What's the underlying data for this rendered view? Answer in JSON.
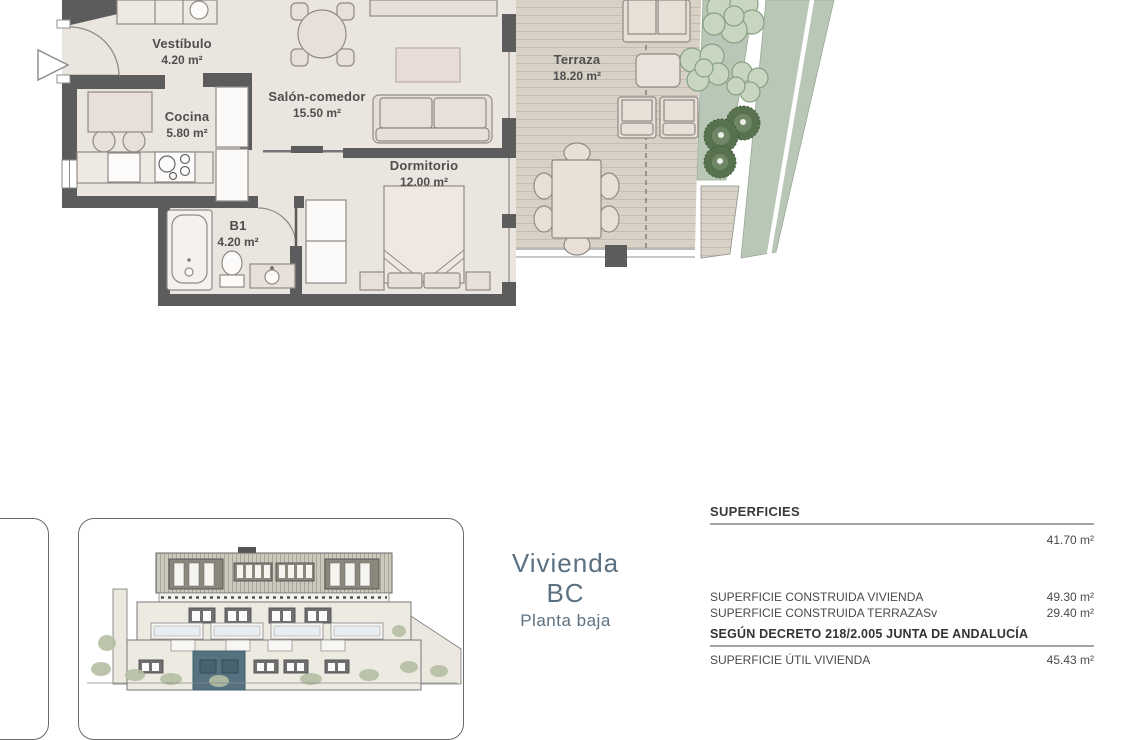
{
  "plan": {
    "rooms": [
      {
        "name": "Vestíbulo",
        "area": "4.20 m²"
      },
      {
        "name": "Cocina",
        "area": "5.80 m²"
      },
      {
        "name": "Salón-comedor",
        "area": "15.50 m²"
      },
      {
        "name": "Dormitorio",
        "area": "12.00 m²"
      },
      {
        "name": "B1",
        "area": "4.20 m²"
      },
      {
        "name": "Terraza",
        "area": "18.20 m²"
      }
    ]
  },
  "unit": {
    "name_line1": "Vivienda",
    "name_line2": "BC",
    "floor_label": "Planta baja"
  },
  "surfaces": {
    "title": "SUPERFICIES",
    "total_value": "41.70 m²",
    "rows": [
      {
        "label": "SUPERFICIE CONSTRUIDA VIVIENDA",
        "value": "49.30 m²"
      },
      {
        "label": "SUPERFICIE CONSTRUIDA TERRAZASv",
        "value": "29.40 m²"
      }
    ],
    "decree_heading": "SEGÚN DECRETO 218/2.005 JUNTA DE ANDALUCÍA",
    "util_row": {
      "label": "SUPERFICIE ÚTIL VIVIENDA",
      "value": "45.43 m²"
    }
  },
  "colors": {
    "wall": "#5c5c5c",
    "floor": "#eae5df",
    "deck": "#d8d1c5",
    "green": "#b9c8b6",
    "accent_unit": "#567280",
    "unit_text": "#5b7080"
  }
}
